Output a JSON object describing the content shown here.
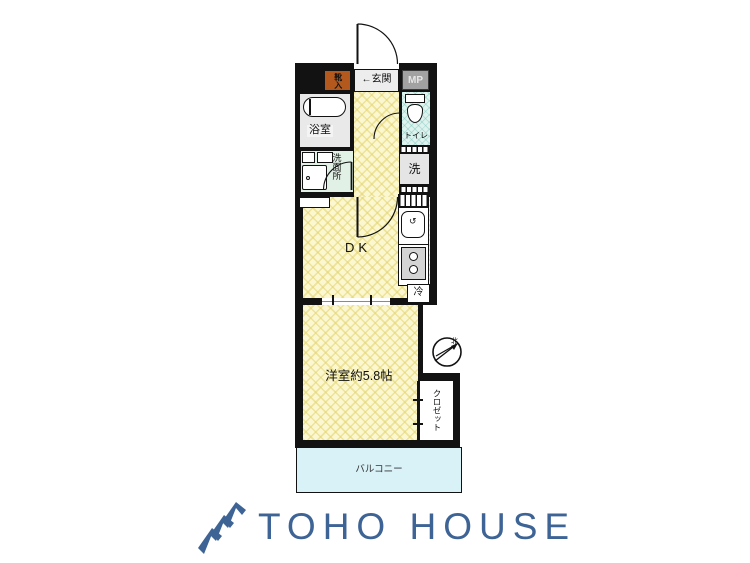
{
  "plan": {
    "rooms": {
      "entrance": "←玄関",
      "shoe_box": "靴入",
      "meter_pipe": "MP",
      "bath": "浴室",
      "toilet": "トイレ",
      "washroom": "洗面所",
      "washer": "洗",
      "dining_kitchen": "DK",
      "fridge": "冷",
      "bedroom": "洋室約5.8帖",
      "closet": "クロゼット",
      "balcony": "バルコニー"
    },
    "compass": {
      "north_label": "北"
    },
    "colors": {
      "wall": "#121212",
      "floor_yellow": "#fbf7d0",
      "toilet_floor": "#def3ee",
      "washroom_floor": "#e2f1e5",
      "bath_floor": "#e9e9e9",
      "shoe_box_bg": "#b3591d",
      "meter_box_bg": "#a2a2a2",
      "balcony_bg": "#d8f2f7"
    }
  },
  "logo": {
    "text": "TOHO HOUSE",
    "color": "#3e6496"
  }
}
